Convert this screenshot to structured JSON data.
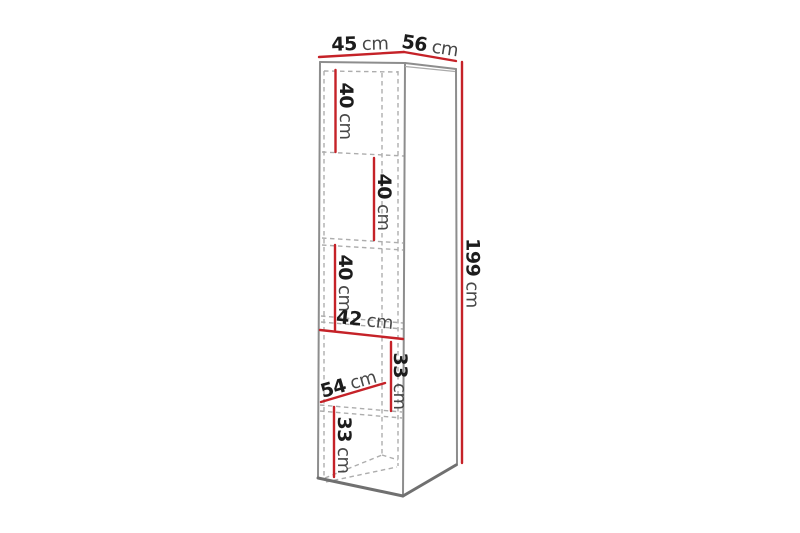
{
  "page": {
    "background": "#ffffff",
    "description": "Dimension diagram of a tall narrow shelving cabinet with five compartments"
  },
  "diagram": {
    "colors": {
      "dimension_red": "#c52228",
      "edge_gray": "#8d8d8d",
      "edge_gray_light": "#aaaaaa",
      "edge_dark": "#707070",
      "dashed_gray": "#adadad",
      "value_black": "#1c1c1c",
      "unit_gray": "#474747"
    },
    "labels": {
      "width": {
        "value": "45",
        "unit": "cm"
      },
      "depth": {
        "value": "56",
        "unit": "cm"
      },
      "height": {
        "value": "199",
        "unit": "cm"
      },
      "compartment1": {
        "value": "40",
        "unit": "cm"
      },
      "compartment2": {
        "value": "40",
        "unit": "cm"
      },
      "compartment3": {
        "value": "40",
        "unit": "cm"
      },
      "inner_width": {
        "value": "42",
        "unit": "cm"
      },
      "compartment4": {
        "value": "33",
        "unit": "cm"
      },
      "inner_depth": {
        "value": "54",
        "unit": "cm"
      },
      "compartment5": {
        "value": "33",
        "unit": "cm"
      }
    }
  }
}
